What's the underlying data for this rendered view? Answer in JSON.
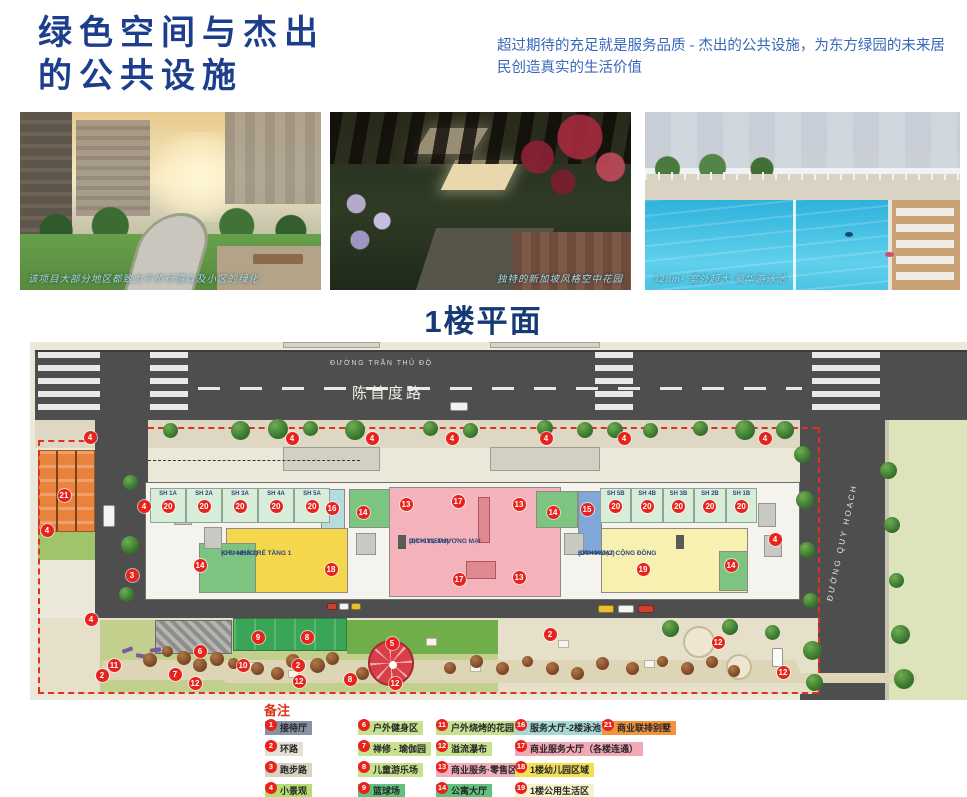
{
  "header": {
    "title_line1": "绿色空间与杰出",
    "title_line2": "的公共设施",
    "subtitle": "超过期待的充足就是服务品质 - 杰出的公共设施，为东方绿园的未来居民创造真实的生活价值"
  },
  "photos": {
    "p1_caption": "该项目大部分地区都致力于步行道以及小区的绿化",
    "p2_caption": "独特的新加坡风格空中花园",
    "p3_caption": "328m² 室外超大 豪华游泳池"
  },
  "plan": {
    "section_title": "1楼平面",
    "street_top_vi": "ĐƯỜNG TRẦN THỦ ĐỘ",
    "street_top_cn": "陈首度路",
    "street_right_vi": "ĐƯỜNG QUY HOẠCH",
    "unit_badge": "20",
    "units_left": [
      "SH 1A",
      "SH 2A",
      "SH 3A",
      "SH 4A",
      "SH 5A"
    ],
    "units_right": [
      "SH 5B",
      "SH 4B",
      "SH 3B",
      "SH 2B",
      "SH 1B"
    ],
    "area_commercial_name": "DỊCH VỤ THƯƠNG MẠI",
    "area_commercial_size": "(DT=1135M2)",
    "area_kindergarten_name": "KHU NHÀ TRẺ TẦNG 1",
    "area_kindergarten_size": "(DT=445M2)",
    "area_community_name": "SINH HOẠT CỘNG ĐỒNG",
    "area_community_size": "(DT=445M2)",
    "markers": [
      {
        "n": "16",
        "x": 302,
        "y": 166
      },
      {
        "n": "14",
        "x": 333,
        "y": 170
      },
      {
        "n": "13",
        "x": 376,
        "y": 162
      },
      {
        "n": "17",
        "x": 428,
        "y": 159
      },
      {
        "n": "13",
        "x": 489,
        "y": 162
      },
      {
        "n": "14",
        "x": 523,
        "y": 170
      },
      {
        "n": "15",
        "x": 557,
        "y": 167
      },
      {
        "n": "14",
        "x": 170,
        "y": 223
      },
      {
        "n": "18",
        "x": 301,
        "y": 227
      },
      {
        "n": "13",
        "x": 489,
        "y": 235
      },
      {
        "n": "17",
        "x": 429,
        "y": 237
      },
      {
        "n": "19",
        "x": 613,
        "y": 227
      },
      {
        "n": "14",
        "x": 701,
        "y": 223
      },
      {
        "n": "4",
        "x": 745,
        "y": 197
      },
      {
        "n": "21",
        "x": 34,
        "y": 153
      },
      {
        "n": "4",
        "x": 17,
        "y": 188
      },
      {
        "n": "4",
        "x": 114,
        "y": 164
      },
      {
        "n": "3",
        "x": 102,
        "y": 233
      },
      {
        "n": "4",
        "x": 60,
        "y": 95
      },
      {
        "n": "4",
        "x": 262,
        "y": 96
      },
      {
        "n": "4",
        "x": 342,
        "y": 96
      },
      {
        "n": "4",
        "x": 422,
        "y": 96
      },
      {
        "n": "4",
        "x": 516,
        "y": 96
      },
      {
        "n": "4",
        "x": 594,
        "y": 96
      },
      {
        "n": "4",
        "x": 735,
        "y": 96
      },
      {
        "n": "4",
        "x": 61,
        "y": 277
      },
      {
        "n": "9",
        "x": 228,
        "y": 295
      },
      {
        "n": "8",
        "x": 277,
        "y": 295
      },
      {
        "n": "5",
        "x": 362,
        "y": 301
      },
      {
        "n": "6",
        "x": 170,
        "y": 309
      },
      {
        "n": "11",
        "x": 84,
        "y": 323
      },
      {
        "n": "2",
        "x": 72,
        "y": 333
      },
      {
        "n": "7",
        "x": 145,
        "y": 332
      },
      {
        "n": "10",
        "x": 213,
        "y": 323
      },
      {
        "n": "2",
        "x": 268,
        "y": 323
      },
      {
        "n": "12",
        "x": 165,
        "y": 341
      },
      {
        "n": "12",
        "x": 269,
        "y": 339
      },
      {
        "n": "8",
        "x": 320,
        "y": 337
      },
      {
        "n": "12",
        "x": 365,
        "y": 341
      },
      {
        "n": "2",
        "x": 520,
        "y": 292
      },
      {
        "n": "12",
        "x": 688,
        "y": 300
      },
      {
        "n": "12",
        "x": 753,
        "y": 330
      }
    ]
  },
  "legend": {
    "title": "备注",
    "columns": [
      [
        {
          "num": "1",
          "label": "接待厅",
          "color": "#8793a2"
        },
        {
          "num": "2",
          "label": "环路",
          "color": "#e4e1d4"
        },
        {
          "num": "3",
          "label": "跑步路",
          "color": "#d9d2c0"
        },
        {
          "num": "4",
          "label": "小景观",
          "color": "#b9dc72"
        },
        {
          "num": "5",
          "label": "景观小屋 - 咖啡厅",
          "color": "#e89aa8"
        }
      ],
      [
        {
          "num": "6",
          "label": "户外健身区",
          "color": "#c8e18f"
        },
        {
          "num": "7",
          "label": "禅修 - 瑜伽园",
          "color": "#c8e18f"
        },
        {
          "num": "8",
          "label": "儿童游乐场",
          "color": "#c8e18f"
        },
        {
          "num": "9",
          "label": "篮球场",
          "color": "#62c17c"
        },
        {
          "num": "10",
          "label": "休闲椅",
          "color": "#c8e18f"
        }
      ],
      [
        {
          "num": "11",
          "label": "户外烧烤的花园",
          "color": "#c8e18f"
        },
        {
          "num": "12",
          "label": "溢流瀑布",
          "color": "#c8e18f"
        },
        {
          "num": "13",
          "label": "商业服务·零售区域",
          "color": "#f2afba"
        },
        {
          "num": "14",
          "label": "公寓大厅",
          "color": "#62c17c"
        },
        {
          "num": "15",
          "label": "办公室大厅",
          "color": "#a9c5e6"
        }
      ],
      [
        {
          "num": "16",
          "label": "服务大厅-2楼泳池",
          "color": "#a6d9d6"
        },
        {
          "num": "17",
          "label": "商业服务大厅（各楼连通）",
          "color": "#f2a9b4"
        },
        {
          "num": "18",
          "label": "1楼幼儿园区域",
          "color": "#f2dd55"
        },
        {
          "num": "19",
          "label": "1楼公用生活区",
          "color": "#f8f2cb"
        },
        {
          "num": "20",
          "label": "1楼店铺区",
          "color": "#cfe9da"
        }
      ],
      [
        {
          "num": "21",
          "label": "商业联排别墅",
          "color": "#f2943e"
        }
      ]
    ]
  }
}
